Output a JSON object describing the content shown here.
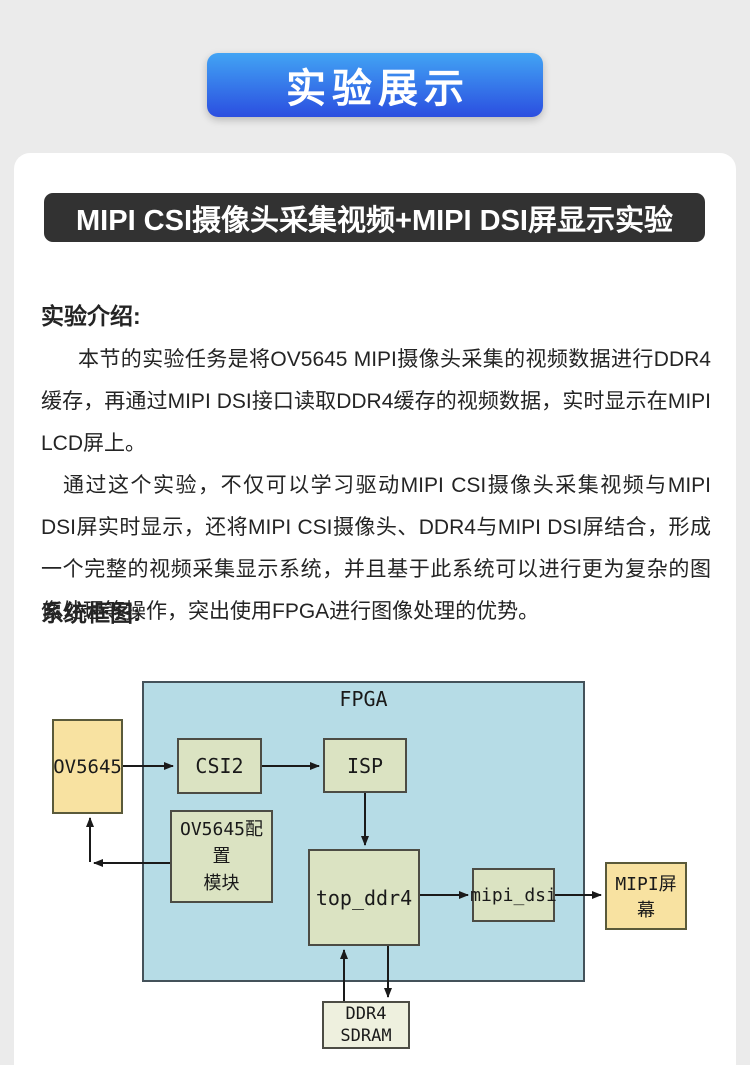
{
  "page": {
    "background": "#ebebeb",
    "card_background": "#ffffff"
  },
  "banner": {
    "label": "实验展示",
    "gradient_top": "#42a4f4",
    "gradient_bottom": "#2b4ee0"
  },
  "title_bar": {
    "text": "MIPI CSI摄像头采集视频+MIPI DSI屏显示实验",
    "background": "#323232"
  },
  "intro": {
    "heading": "实验介绍:",
    "paragraphs": [
      "本节的实验任务是将OV5645 MIPI摄像头采集的视频数据进行DDR4缓存，再通过MIPI DSI接口读取DDR4缓存的视频数据，实时显示在MIPI LCD屏上。",
      "通过这个实验，不仅可以学习驱动MIPI CSI摄像头采集视频与MIPI DSI屏实时显示，还将MIPI CSI摄像头、DDR4与MIPI DSI屏结合，形成一个完整的视频采集显示系统，并且基于此系统可以进行更为复杂的图像处理等操作，突出使用FPGA进行图像处理的优势。"
    ]
  },
  "diagram": {
    "heading": "系统框图:",
    "container_label": "FPGA",
    "nodes": {
      "ov5645": "OV5645",
      "csi2": "CSI2",
      "isp": "ISP",
      "config_line1": "OV5645配置",
      "config_line2": "模块",
      "top_ddr4": "top_ddr4",
      "mipi_dsi": "mipi_dsi",
      "screen": "MIPI屏幕",
      "ddr4_line1": "DDR4",
      "ddr4_line2": "SDRAM"
    },
    "colors": {
      "fpga_fill": "#b6dce6",
      "module_fill": "#dbe3c2",
      "external_fill": "#f8e2a1",
      "ddr4_fill": "#eef0de",
      "arrow": "#1a1a1a"
    }
  }
}
